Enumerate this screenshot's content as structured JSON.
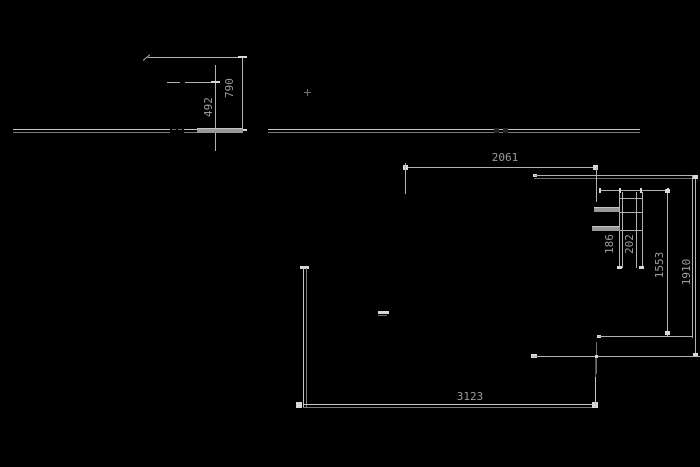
{
  "drawing": {
    "type": "cad-technical-drawing",
    "colors": {
      "background": "#000000",
      "line": "#b2b2b2",
      "bright_marker": "#d8d8d8",
      "dim_shadow": "#7a7a7a",
      "label_text": "#9c9c9c"
    },
    "dimensions": {
      "elevation_detail": {
        "overall_height": "790",
        "partial_height": "492"
      },
      "plan": {
        "top_width": "2061",
        "bottom_width": "3123",
        "right_height": "1910",
        "inner_height": "1553",
        "post_depth": "186",
        "post_width": "202"
      }
    }
  }
}
